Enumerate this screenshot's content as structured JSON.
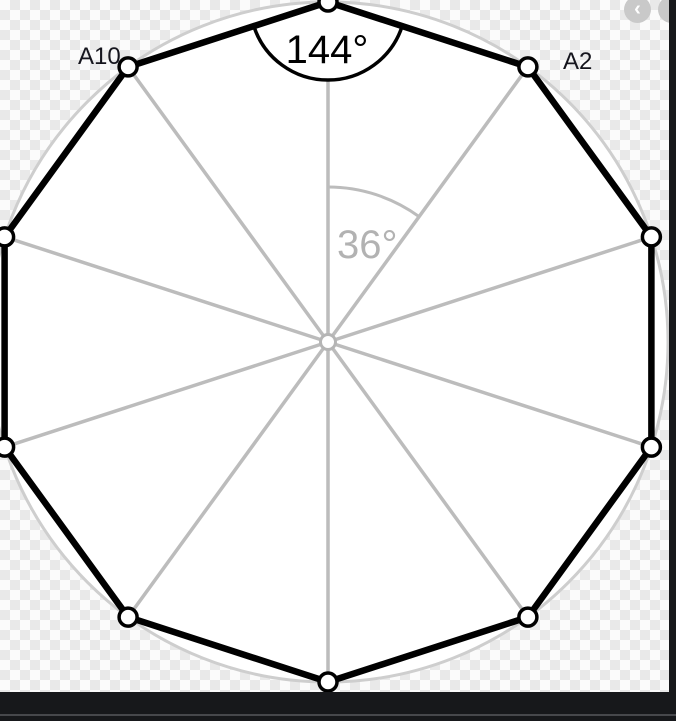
{
  "figure": {
    "description": "Regular decagon inscribed in a circle with all ten radii drawn from the center",
    "sides": 10,
    "interior_angle": {
      "label": "144°",
      "value": 144
    },
    "central_angle": {
      "label": "36°",
      "value": 36
    },
    "vertex_labels": {
      "a10": "A10",
      "a2": "A2"
    },
    "colors": {
      "polygon_stroke": "#000000",
      "radii_stroke": "#bcbcbc",
      "circumcircle_stroke": "#cecece",
      "disk_fill": "#ffffff",
      "interior_angle_text": "#000000",
      "central_angle_text": "#b2b2b2",
      "point_label_text": "#15151d",
      "checker_gray": "#e9e9e9",
      "chrome_dark": "#17181b",
      "nav_button_bg": "#c9c9c9"
    }
  },
  "viewer": {
    "prev_label": "‹",
    "next_label": "›"
  }
}
